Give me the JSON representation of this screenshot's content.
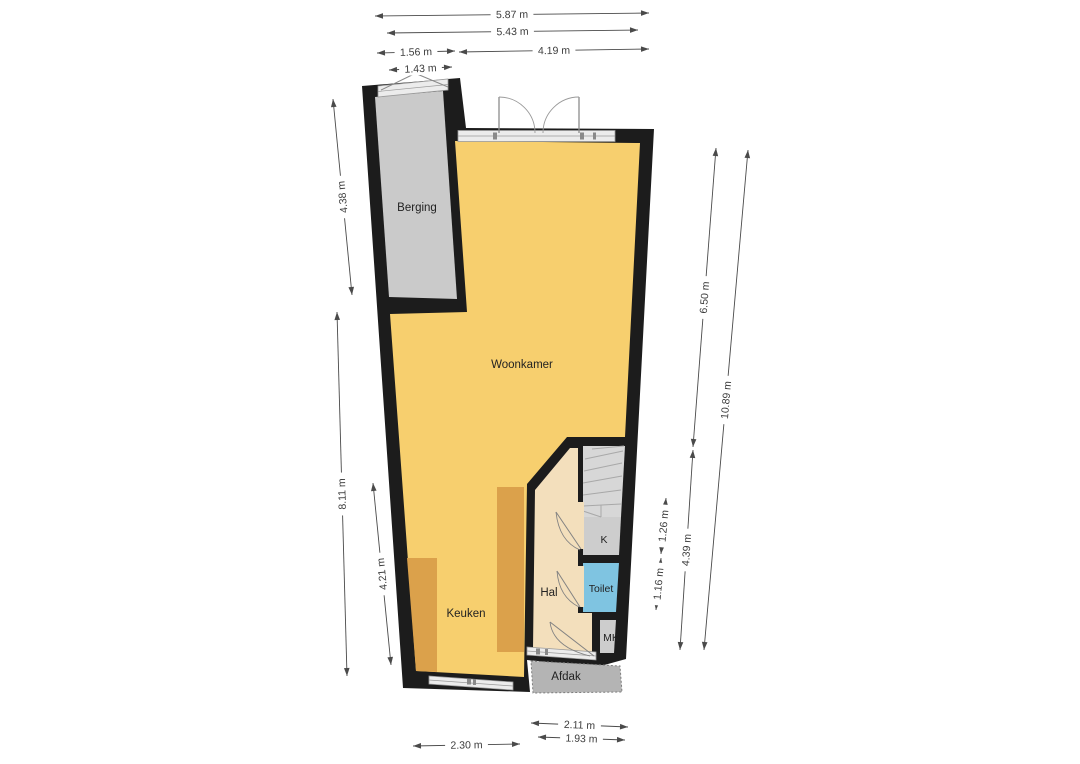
{
  "plan": {
    "rooms": {
      "berging": {
        "label": "Berging"
      },
      "woonkamer": {
        "label": "Woonkamer"
      },
      "keuken": {
        "label": "Keuken"
      },
      "hal": {
        "label": "Hal"
      },
      "toilet": {
        "label": "Toilet"
      },
      "kast": {
        "label": "K"
      },
      "meterkast": {
        "label": "MK"
      },
      "afdak": {
        "label": "Afdak"
      }
    },
    "dimensions": {
      "top": [
        {
          "id": "t1",
          "label": "5.87 m"
        },
        {
          "id": "t2",
          "label": "5.43 m"
        },
        {
          "id": "t3",
          "label": "1.56 m"
        },
        {
          "id": "t4",
          "label": "4.19 m"
        },
        {
          "id": "t5",
          "label": "1.43 m"
        }
      ],
      "left": [
        {
          "id": "l1",
          "label": "4.38 m"
        },
        {
          "id": "l2",
          "label": "8.11 m"
        },
        {
          "id": "l3",
          "label": "4.21 m"
        }
      ],
      "right": [
        {
          "id": "r1",
          "label": "6.50 m"
        },
        {
          "id": "r2",
          "label": "10.89 m"
        },
        {
          "id": "r3",
          "label": "4.39 m"
        },
        {
          "id": "r4",
          "label": "1.26 m"
        },
        {
          "id": "r5",
          "label": "1.16 m"
        }
      ],
      "bottom": [
        {
          "id": "b1",
          "label": "2.30 m"
        },
        {
          "id": "b2",
          "label": "2.11 m"
        },
        {
          "id": "b3",
          "label": "1.93 m"
        }
      ]
    },
    "colors": {
      "wall": "#1c1c1c",
      "floor_main": "#f7cf6e",
      "counter": "#dba14b",
      "hal_floor": "#f3dfbc",
      "berging_floor": "#cacaca",
      "stairs": "#d7d7d7",
      "closet": "#cdcdcd",
      "toilet": "#7fc4e1",
      "afdak": "#b4b4b4",
      "window_band": "#ececec",
      "door_stroke": "#828282",
      "dim_line": "#4a4a4a"
    }
  }
}
